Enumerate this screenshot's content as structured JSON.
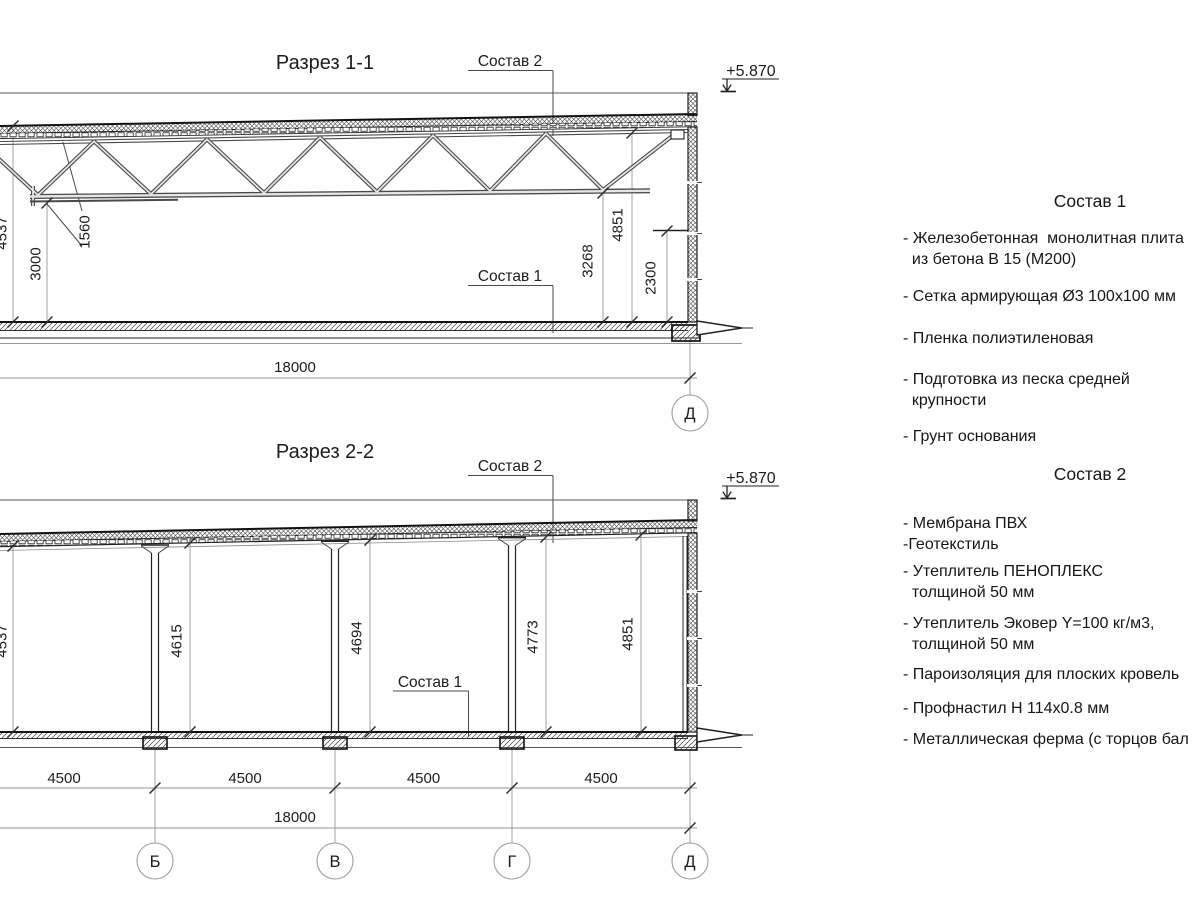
{
  "page": {
    "background": "#ffffff",
    "line_color": "#222222",
    "accent_gray": "#969696"
  },
  "callouts": {
    "sostav1": "Состав 1",
    "sostav2": "Состав 2",
    "elevation": "+5.870"
  },
  "section1": {
    "title": "Разрез 1-1",
    "axis_d": "Д",
    "dims": {
      "total_height": "4537",
      "clear_height": "3000",
      "truss_height": "1560",
      "d3268": "3268",
      "d4851": "4851",
      "d2300": "2300",
      "span": "18000"
    }
  },
  "section2": {
    "title": "Разрез 2-2",
    "axes": {
      "b": "Б",
      "v": "В",
      "g": "Г",
      "d": "Д"
    },
    "dims": {
      "h1": "4537",
      "h2": "4615",
      "h3": "4694",
      "h4": "4773",
      "h5": "4851",
      "span": "18000",
      "bays": [
        "4500",
        "4500",
        "4500",
        "4500"
      ]
    }
  },
  "notes1": {
    "title": "Состав 1",
    "items": [
      "- Железобетонная  монолитная плита\n  из бетона В 15 (М200)",
      "- Сетка армирующая Ø3 100х100 мм",
      "- Пленка полиэтиленовая",
      "- Подготовка из песка средней\n  крупности",
      "- Грунт основания"
    ]
  },
  "notes2": {
    "title": "Состав 2",
    "items": [
      "- Мембрана ПВХ\n-Геотекстиль",
      "- Утеплитель ПЕНОПЛЕКС\n  толщиной 50 мм",
      "- Утеплитель Эковер Y=100 кг/м3,\n  толщиной 50 мм",
      "- Пароизоляция для плоских кровель",
      "- Профнастил Н 114х0.8 мм",
      "- Металлическая ферма (с торцов бал"
    ]
  }
}
